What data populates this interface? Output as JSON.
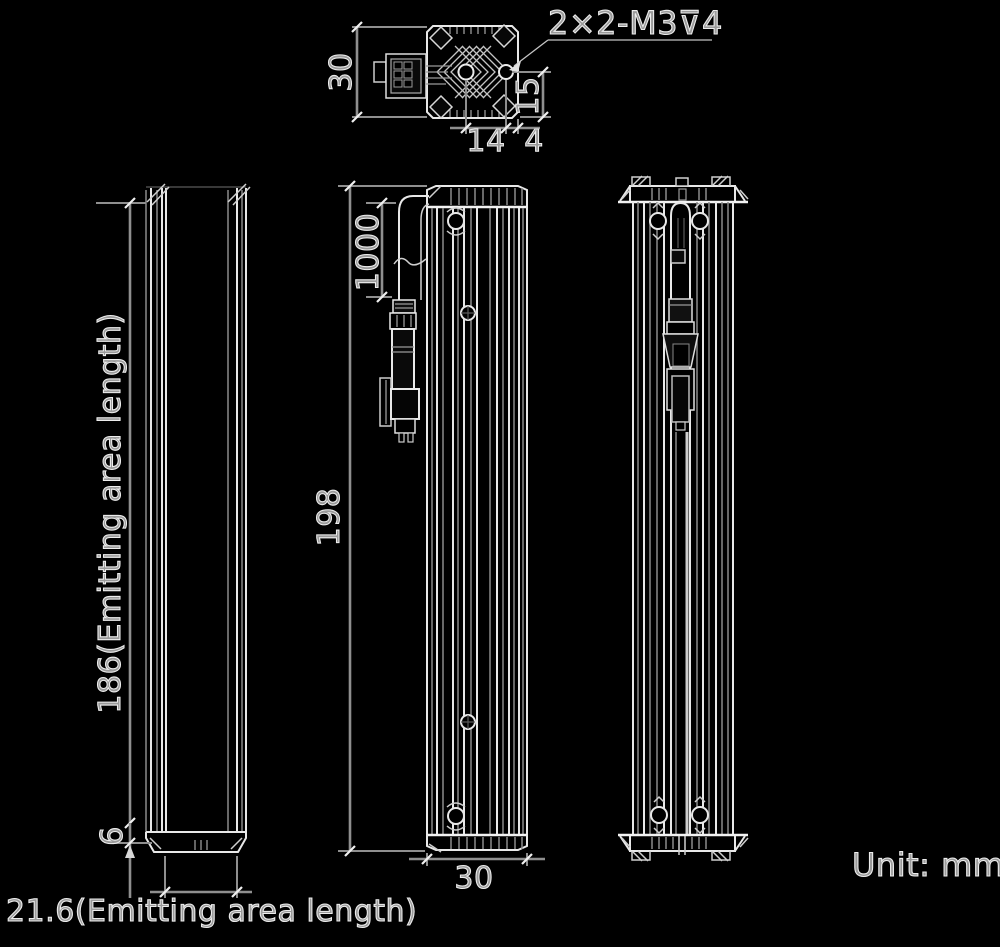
{
  "unit_label": "Unit: mm",
  "top_view": {
    "thread_callout": "2×2-M3⊽4",
    "dim_height": "30",
    "dim_hole_to_bottom": "15",
    "dim_hole_spacing": "14",
    "dim_hole_to_edge": "4"
  },
  "side_view": {
    "dim_emitting_length": "186(Emitting area length)",
    "dim_end_offset": "6",
    "dim_emitting_width": "21.6(Emitting area length)"
  },
  "front_view": {
    "dim_cable_length": "1000",
    "dim_total_length": "198",
    "dim_width": "30"
  },
  "colors": {
    "background": "#000000",
    "outline": "#e8e8e8",
    "dimension_line": "#8f8f8f",
    "text": "#c9c9c9"
  }
}
